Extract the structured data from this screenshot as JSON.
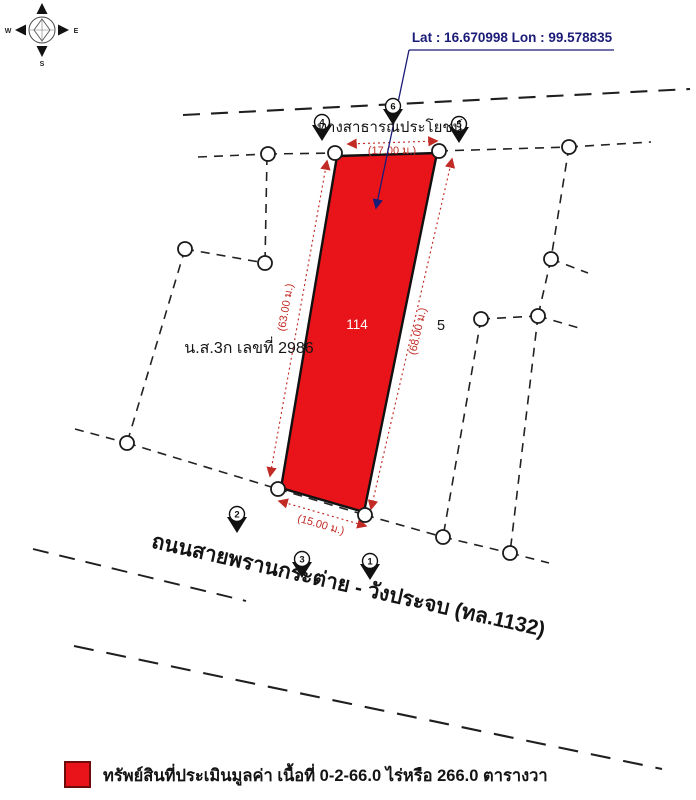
{
  "colors": {
    "parcel_fill": "#e81419",
    "parcel_border": "#111111",
    "dimension_red": "#c22b25",
    "annotation_blue": "#1b1b78",
    "boundary_black": "#1a1a1a",
    "legend_swatch": "#e81419"
  },
  "annotation": {
    "coordinates_label": "Lat : 16.670998  Lon : 99.578835"
  },
  "compass": {
    "west": "W",
    "east": "E",
    "south": "S"
  },
  "map": {
    "parcel_number": "114",
    "adjacent_lot_number": "5",
    "deed_label": "น.ส.3ก เลขที่ 2986",
    "public_way_label": "ทางสาธารณประโยชน์",
    "road_label": "ถนนสายพรานกระต่าย - วังประจบ (ทล.1132)",
    "dimensions": {
      "top": "(17.00 ม.)",
      "left": "(63.00 ม.)",
      "right": "(68.00 ม.)",
      "bottom": "(15.00 ม.)"
    },
    "photo_markers": {
      "m1": "1",
      "m2": "2",
      "m3": "3",
      "m4": "4",
      "m5": "5",
      "m6": "6"
    }
  },
  "legend": {
    "label": "ทรัพย์สินที่ประเมินมูลค่า เนื้อที่ 0-2-66.0 ไร่หรือ 266.0 ตารางวา"
  }
}
